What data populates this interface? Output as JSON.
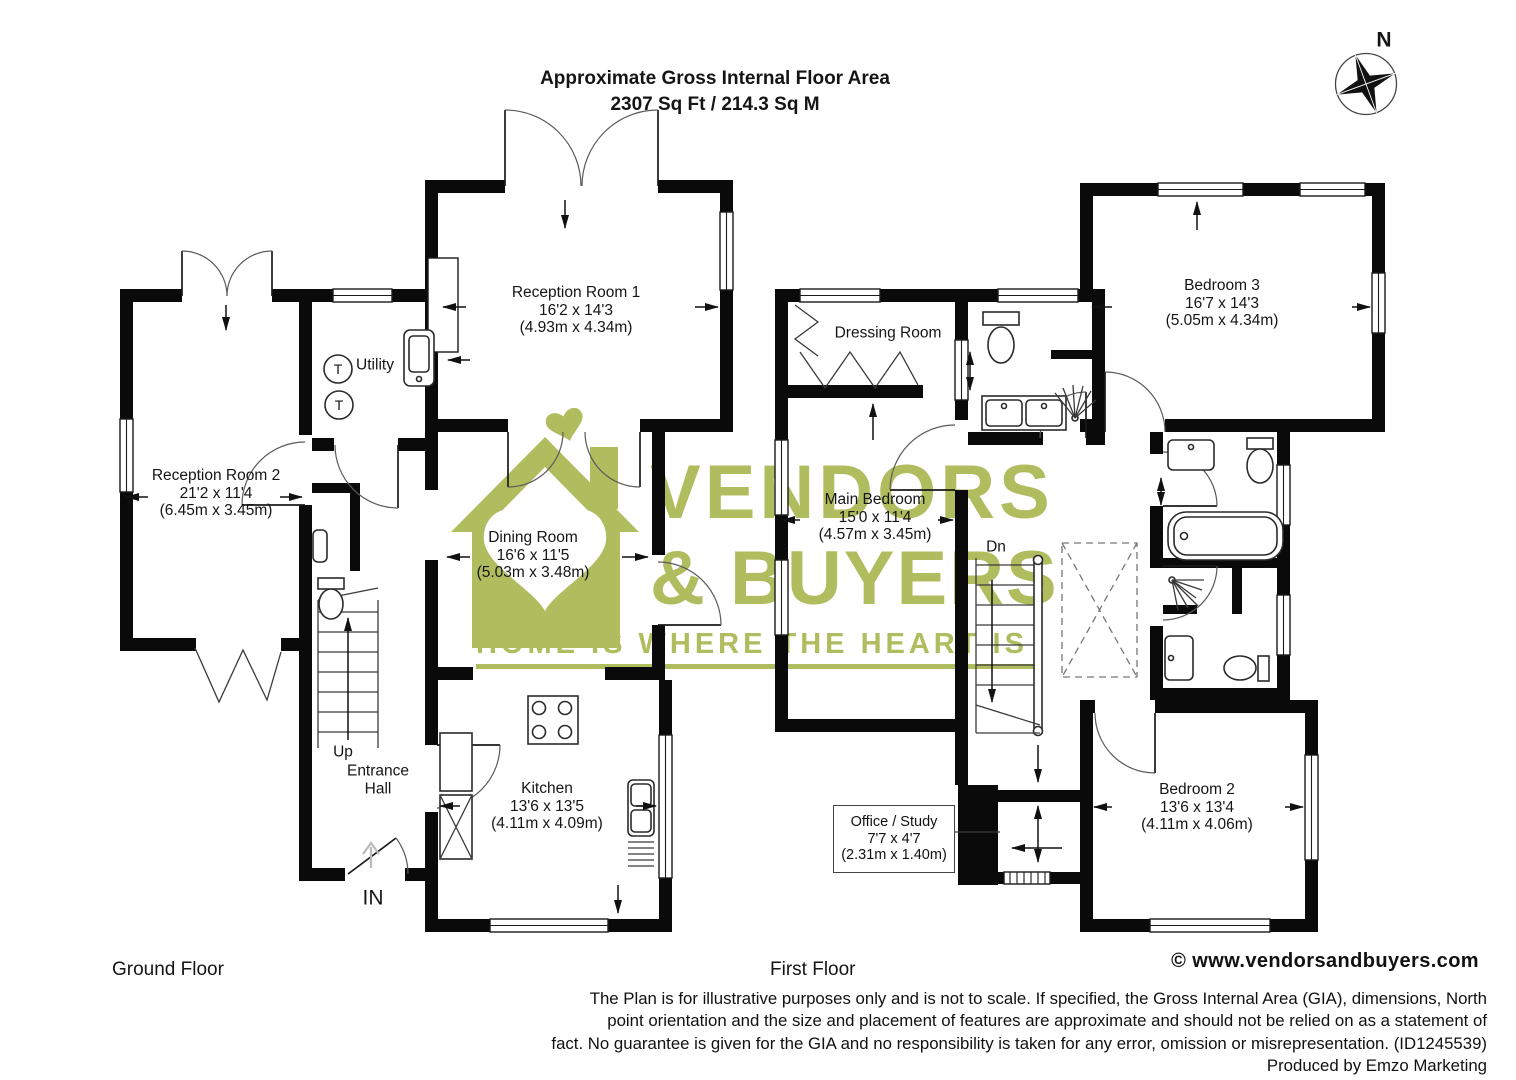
{
  "header": {
    "title_line1": "Approximate Gross Internal Floor Area",
    "title_line2": "2307 Sq Ft / 214.3 Sq M",
    "compass": "N"
  },
  "watermark": {
    "line1": "VENDORS",
    "line2": "& BUYERS",
    "tagline": "HOME IS WHERE THE HEART IS",
    "color": "#b0bd5e"
  },
  "ground_floor": {
    "title": "Ground Floor",
    "rooms": {
      "reception1": {
        "name": "Reception Room 1",
        "dims_ft": "16'2 x 14'3",
        "dims_m": "(4.93m x 4.34m)"
      },
      "reception2": {
        "name": "Reception Room 2",
        "dims_ft": "21'2 x 11'4",
        "dims_m": "(6.45m x 3.45m)"
      },
      "utility": {
        "name": "Utility"
      },
      "dining": {
        "name": "Dining Room",
        "dims_ft": "16'6 x 11'5",
        "dims_m": "(5.03m x 3.48m)"
      },
      "kitchen": {
        "name": "Kitchen",
        "dims_ft": "13'6 x 13'5",
        "dims_m": "(4.11m x 4.09m)"
      },
      "entrance_hall": {
        "line1": "Entrance",
        "line2": "Hall"
      }
    },
    "labels": {
      "up": "Up",
      "in": "IN",
      "tumble1": "T",
      "tumble2": "T"
    }
  },
  "first_floor": {
    "title": "First Floor",
    "rooms": {
      "dressing": {
        "name": "Dressing Room"
      },
      "main_bedroom": {
        "name": "Main Bedroom",
        "dims_ft": "15'0 x 11'4",
        "dims_m": "(4.57m x 3.45m)"
      },
      "bedroom3": {
        "name": "Bedroom 3",
        "dims_ft": "16'7 x 14'3",
        "dims_m": "(5.05m x 4.34m)"
      },
      "bedroom2": {
        "name": "Bedroom 2",
        "dims_ft": "13'6 x 13'4",
        "dims_m": "(4.11m x 4.06m)"
      },
      "office": {
        "name": "Office / Study",
        "dims_ft": "7'7 x 4'7",
        "dims_m": "(2.31m x 1.40m)"
      }
    },
    "labels": {
      "dn": "Dn"
    }
  },
  "footer": {
    "copyright": "©",
    "website": "www.vendorsandbuyers.com",
    "disclaimer_lines": [
      "The Plan is for illustrative purposes only and is not to scale. If specified, the Gross Internal Area (GIA), dimensions, North",
      "point orientation and the size and placement of features are approximate and should not be relied on as a statement of",
      "fact. No guarantee is given for the GIA and no responsibility is taken for any error, omission or misrepresentation. (ID1245539)"
    ],
    "produced_by": "Produced by Emzo Marketing"
  }
}
